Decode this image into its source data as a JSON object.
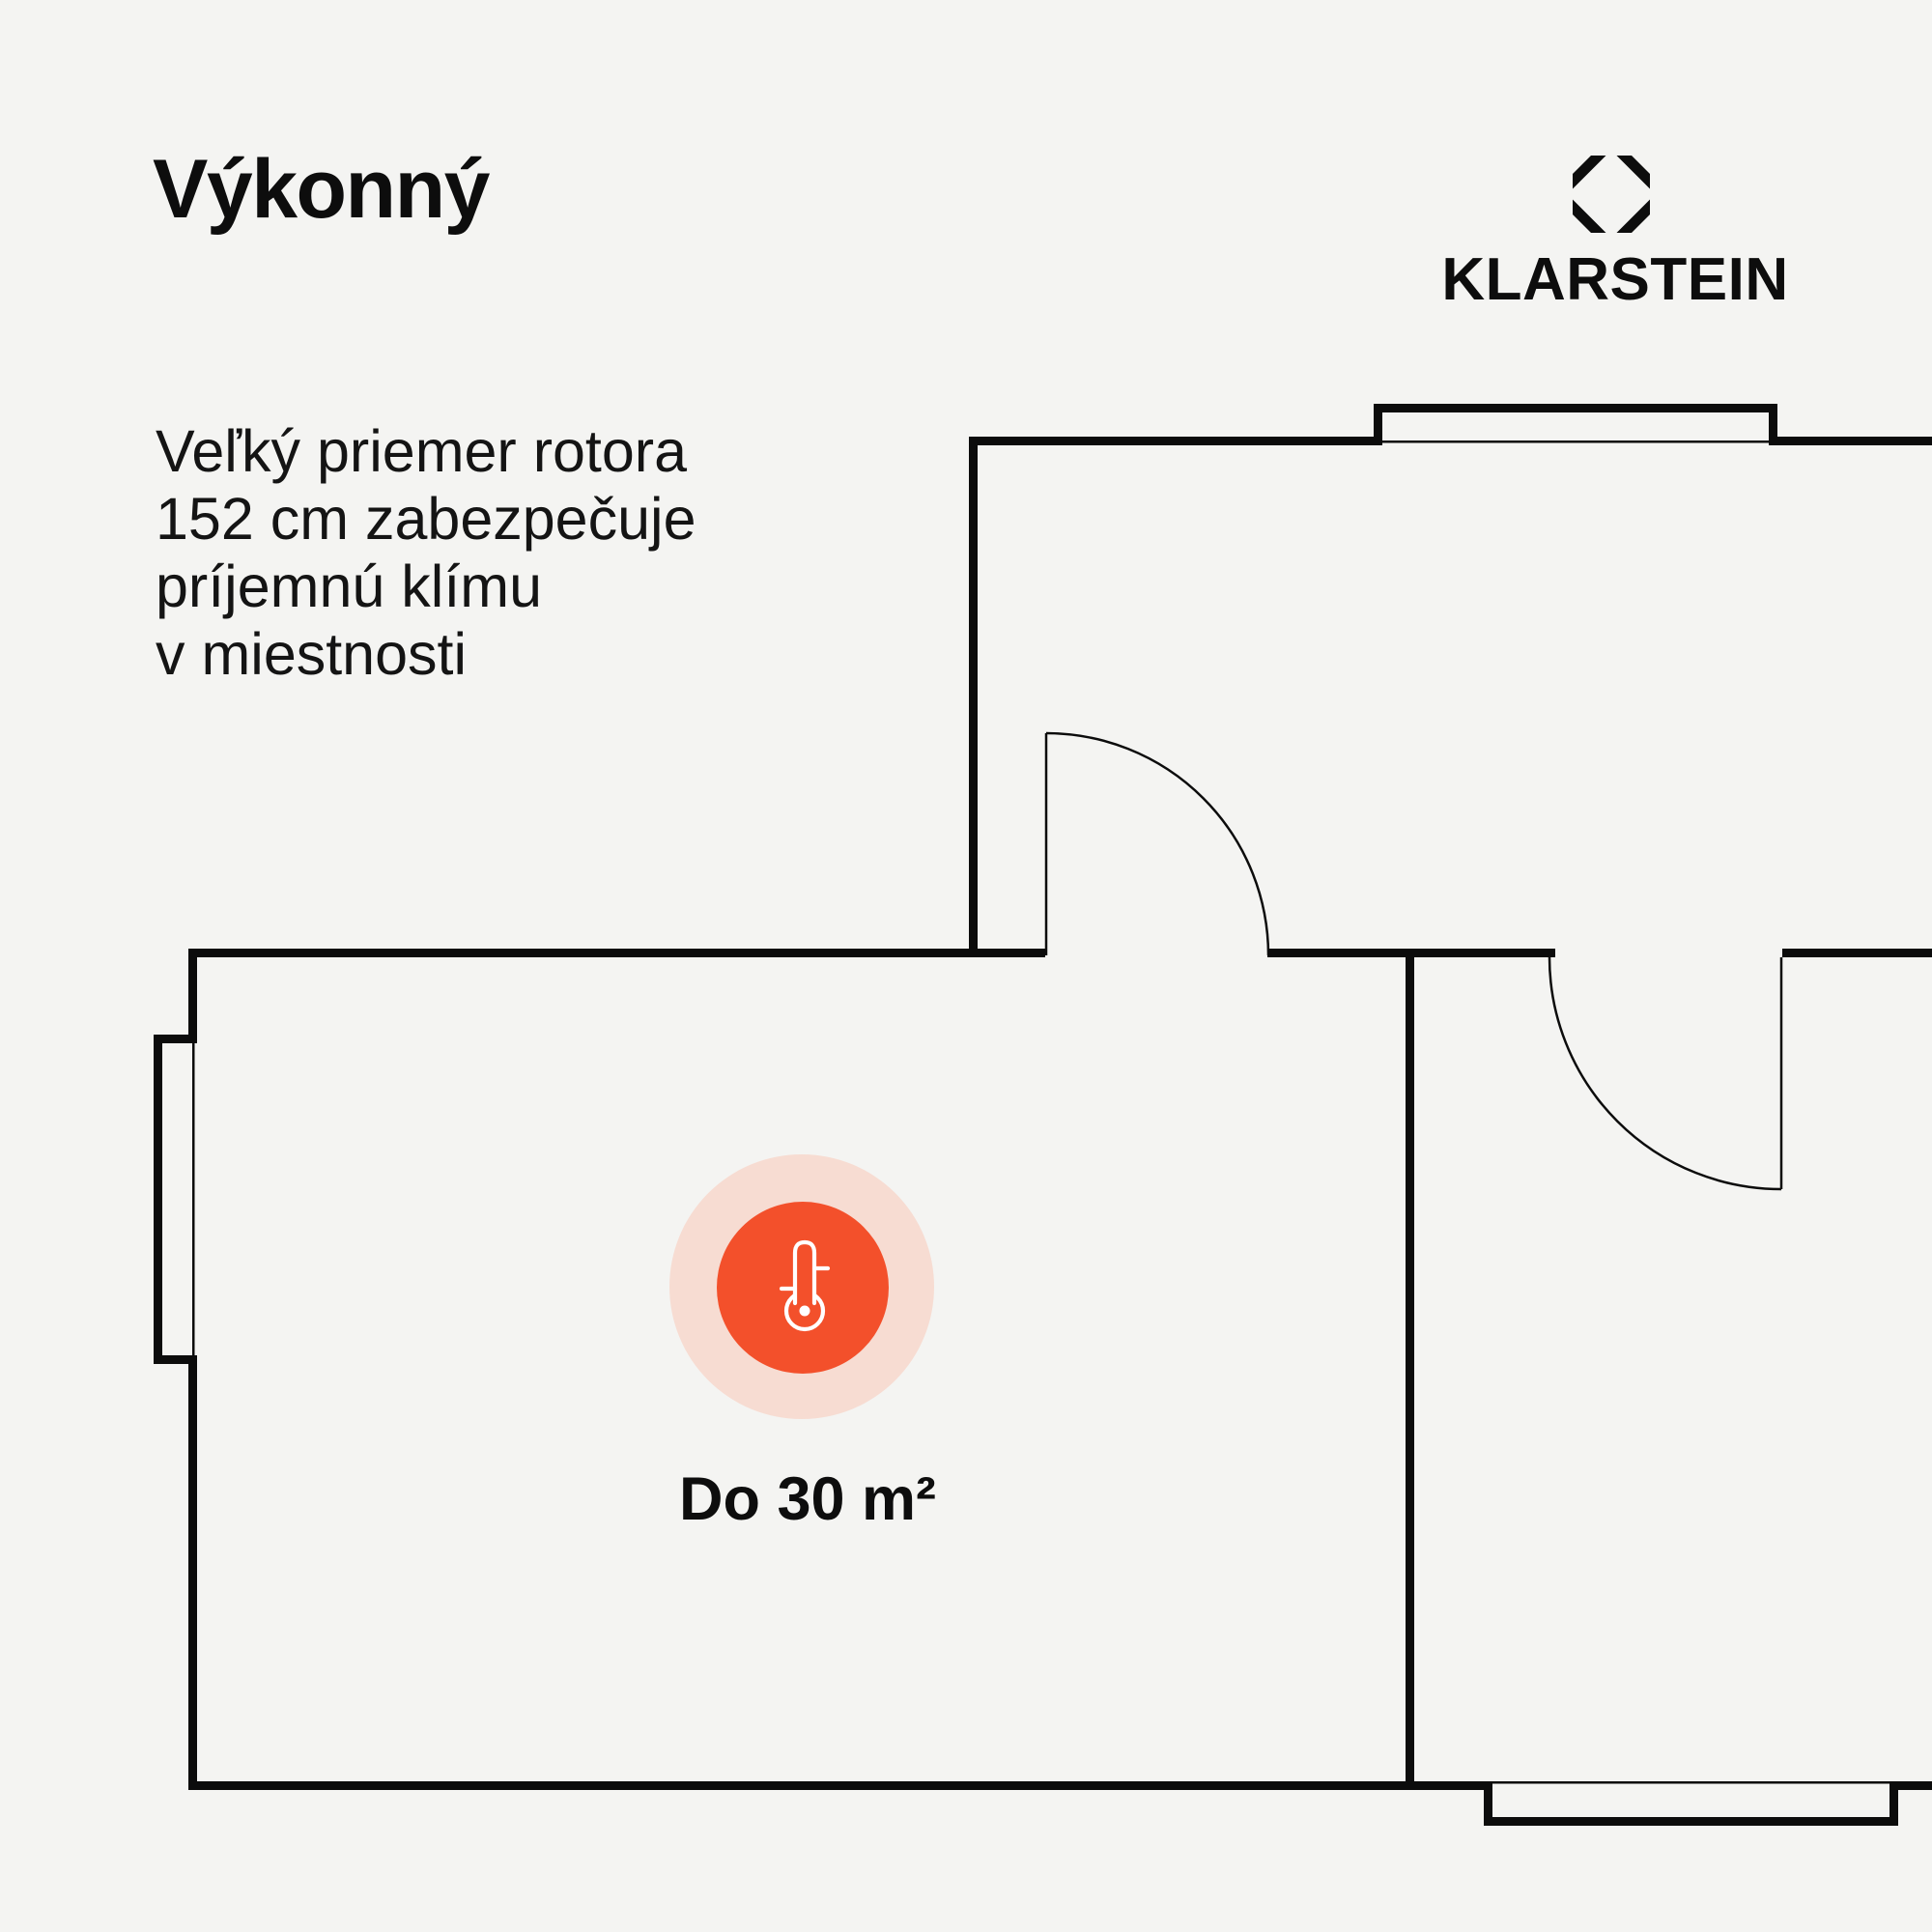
{
  "header": {
    "title": "Výkonný",
    "description_lines": [
      "Veľký priemer rotora",
      "152 cm zabezpečuje",
      "príjemnú klímu",
      "v miestnosti"
    ]
  },
  "brand": {
    "name": "KLARSTEIN",
    "logo_icon": "octagon-diamond-mark"
  },
  "marker": {
    "label": "Do 30 m²",
    "icon": "thermometer-icon"
  },
  "floor_plan": {
    "description": "apartment floor plan with marked room, two swing doors and three windows",
    "marked_room_label": "Do 30 m²"
  },
  "colors": {
    "background": "#f4f4f2",
    "wall": "#0c0c0c",
    "text": "#141414",
    "accent_orange": "#f3502b",
    "accent_halo": "#f7dcd2",
    "icon_stroke": "#ffffff"
  }
}
